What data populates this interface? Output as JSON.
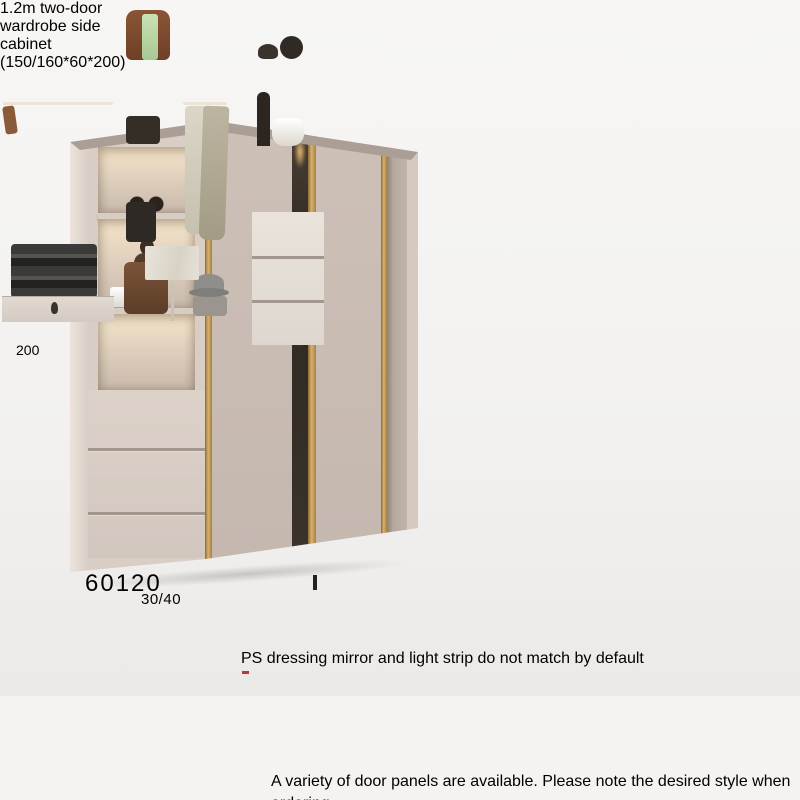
{
  "scene": {
    "kind": "furniture product photo",
    "product": "sliding-door wardrobe with open side cabinet"
  },
  "annotations": {
    "height_label": "200",
    "width_label": "60120",
    "depth_label": "30/40",
    "note": "PS dressing mirror and light strip do not match by default"
  },
  "title_bar": {
    "text": "1.2m two-door wardrobe   side cabinet (150/160*60*200)"
  },
  "footer": {
    "text": "A variety of door panels are available. Please note the desired style when ordering."
  },
  "left_wardrobe": {
    "type": "closed wardrobe, two sliding doors with gold trim, side shelf column",
    "shelf_items": [
      "eyewear-decor",
      "bust-sculpture",
      "patterned-handbag"
    ],
    "drawer_count": 3
  },
  "right_wardrobe": {
    "type": "open wardrobe interior",
    "items": [
      "white-pillows",
      "gray-storage-boxes",
      "handbag-with-green-scarf",
      "white-shirts",
      "plaid-jackets",
      "folded-clothes",
      "keyhole-drawer",
      "dressing-mirror",
      "leather-bag",
      "hat-and-box",
      "decor-objects",
      "white-tureen",
      "dark-handbag"
    ],
    "drawer_count": 3
  },
  "colors": {
    "background": "#f4f3f1",
    "dark_band": "#3b3b3b",
    "gold_trim": "#c9a363",
    "cabinet_beige": "#cfc3ba",
    "door_gray": "#8b8b89",
    "text_dark": "#1c1c1c",
    "note_mark_red": "#b43b36",
    "annotation_box": "#ffffff"
  }
}
